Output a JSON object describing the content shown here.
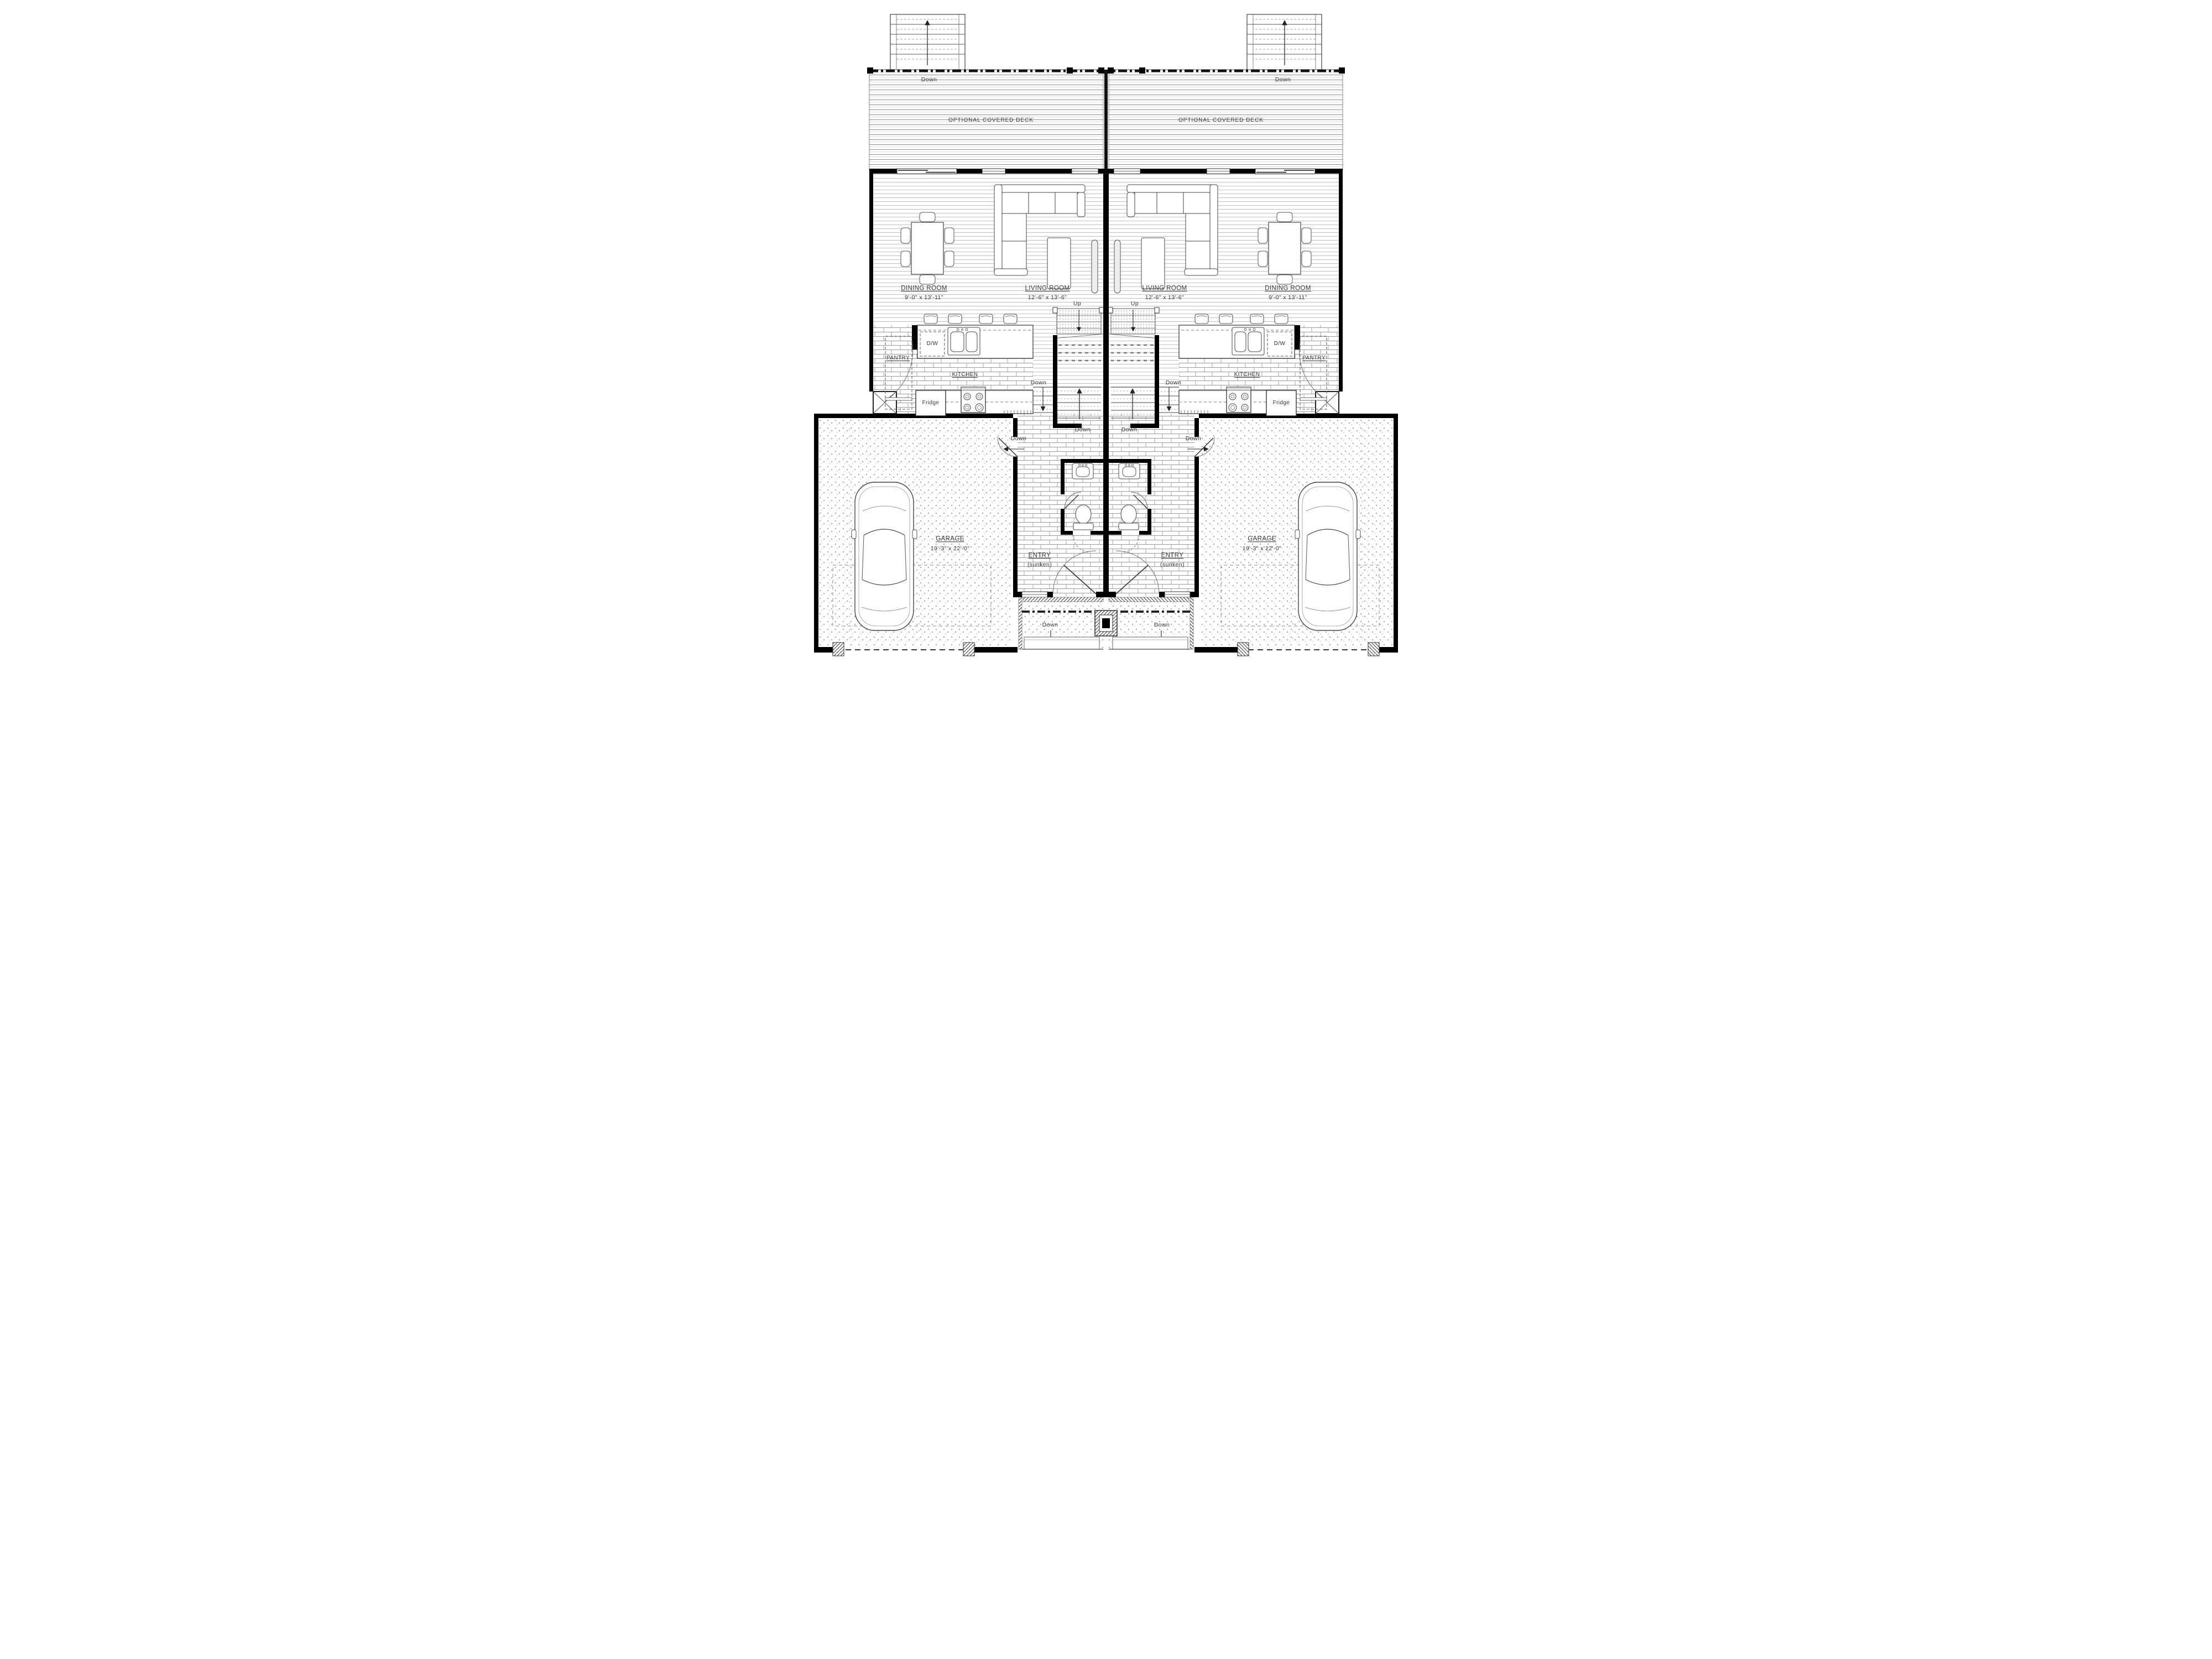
{
  "drawing": {
    "type": "duplex main floor plan, two mirrored units"
  },
  "labels": {
    "optional_covered_deck": "OPTIONAL COVERED DECK",
    "dining_room": "DINING ROOM",
    "dining_dim": "9'-0\" x 13'-11\"",
    "living_room": "LIVING ROOM",
    "living_dim": "12'-6\" x 13'-6\"",
    "kitchen": "KITCHEN",
    "pantry": "PANTRY",
    "dw": "D/W",
    "fridge": "Fridge",
    "garage": "GARAGE",
    "garage_dim": "19'-3\" x 22'-0\"",
    "entry": "ENTRY",
    "entry_sub": "(sunken)",
    "up": "Up",
    "down": "Down"
  },
  "colors": {
    "wall": "#000000",
    "line": "#444444",
    "label": "#353535",
    "background": "#ffffff"
  }
}
